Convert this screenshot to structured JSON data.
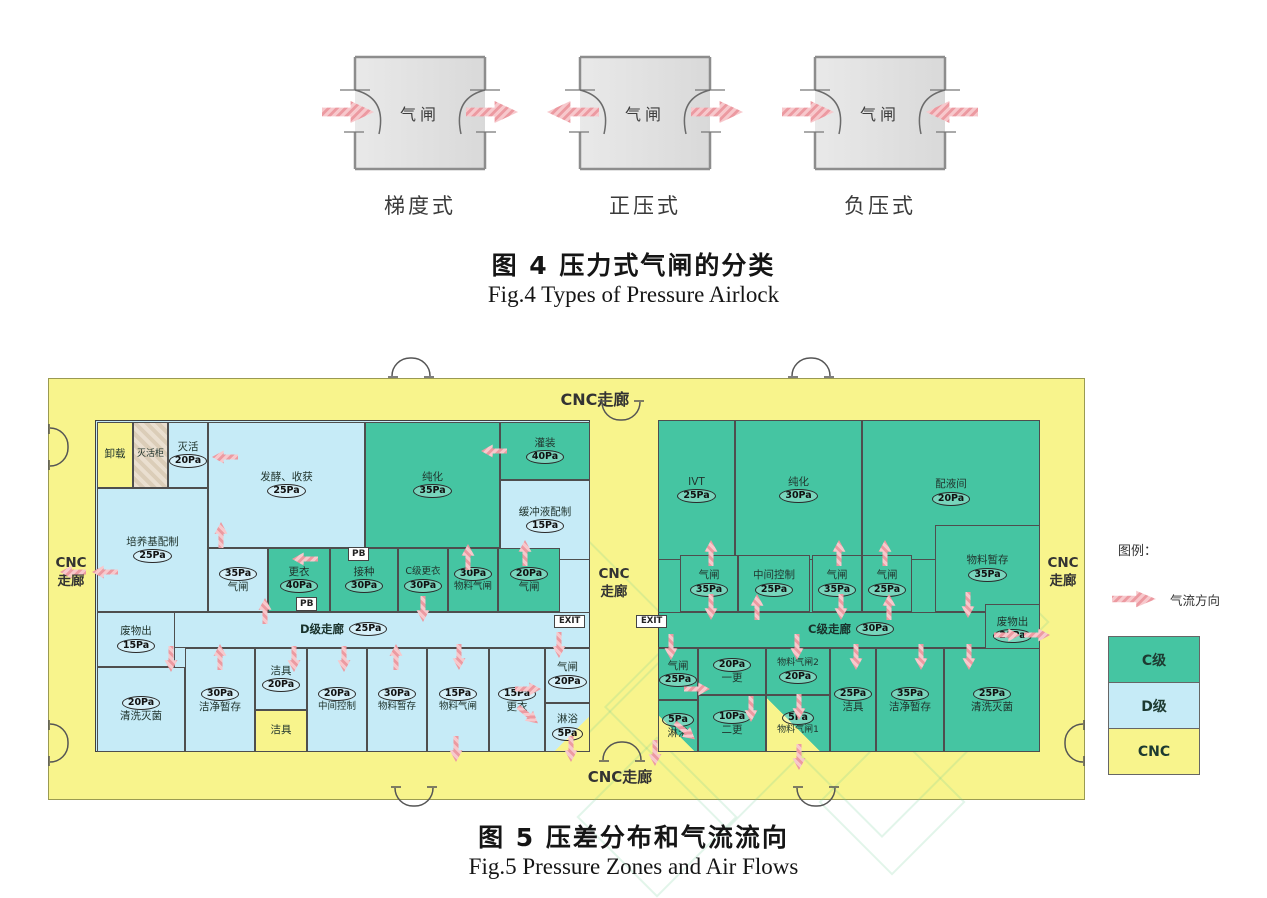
{
  "figure4": {
    "caption_cn": "图 4  压力式气闸的分类",
    "caption_en": "Fig.4  Types of Pressure Airlock",
    "airlocks": [
      {
        "room_label": "气闸",
        "type_label": "梯度式"
      },
      {
        "room_label": "气闸",
        "type_label": "正压式"
      },
      {
        "room_label": "气闸",
        "type_label": "负压式"
      }
    ]
  },
  "figure5": {
    "caption_cn": "图 5  压差分布和气流流向",
    "caption_en": "Fig.5  Pressure Zones and Air Flows",
    "corridors": {
      "top": "CNC走廊",
      "bottom": "CNC走廊",
      "left_l1": "CNC",
      "left_l2": "走廊",
      "middle_l1": "CNC",
      "middle_l2": "走廊",
      "right_l1": "CNC",
      "right_l2": "走廊",
      "d_corridor": "D级走廊",
      "d_pressure": "25Pa",
      "c_corridor": "C级走廊",
      "c_pressure": "30Pa"
    },
    "exit_label": "EXIT",
    "pb_label": "PB",
    "left_rooms": [
      {
        "label": "卸载",
        "pressure": ""
      },
      {
        "label": "灭活柜",
        "pressure": ""
      },
      {
        "label": "灭活",
        "pressure": "20Pa"
      },
      {
        "label": "培养基配制",
        "pressure": "25Pa"
      },
      {
        "label": "发酵、收获",
        "pressure": "25Pa"
      },
      {
        "label": "纯化",
        "pressure": "35Pa"
      },
      {
        "label": "灌装",
        "pressure": "40Pa"
      },
      {
        "label": "缓冲液配制",
        "pressure": "15Pa"
      },
      {
        "label": "气闸",
        "pressure": "35Pa"
      },
      {
        "label": "更衣",
        "pressure": "40Pa"
      },
      {
        "label": "接种",
        "pressure": "30Pa"
      },
      {
        "label": "C级更衣",
        "pressure": "30Pa"
      },
      {
        "label": "物料气闸",
        "pressure": "30Pa"
      },
      {
        "label": "气闸",
        "pressure": "20Pa"
      },
      {
        "label": "废物出",
        "pressure": "15Pa"
      },
      {
        "label": "清洗灭菌",
        "pressure": "20Pa"
      },
      {
        "label": "洁净暂存",
        "pressure": "30Pa"
      },
      {
        "label": "洁具",
        "pressure": "20Pa"
      },
      {
        "label": "洁具",
        "pressure": ""
      },
      {
        "label": "中间控制",
        "pressure": "20Pa"
      },
      {
        "label": "物料暂存",
        "pressure": "30Pa"
      },
      {
        "label": "物料气闸",
        "pressure": "15Pa"
      },
      {
        "label": "更衣",
        "pressure": "15Pa"
      },
      {
        "label": "气闸",
        "pressure": "20Pa"
      },
      {
        "label": "淋浴",
        "pressure": "5Pa"
      }
    ],
    "right_rooms": [
      {
        "label": "IVT",
        "pressure": "25Pa"
      },
      {
        "label": "纯化",
        "pressure": "30Pa"
      },
      {
        "label": "配液间",
        "pressure": "20Pa"
      },
      {
        "label": "物料暂存",
        "pressure": "35Pa"
      },
      {
        "label": "气闸",
        "pressure": "35Pa"
      },
      {
        "label": "中间控制",
        "pressure": "25Pa"
      },
      {
        "label": "气闸",
        "pressure": "35Pa"
      },
      {
        "label": "气闸",
        "pressure": "25Pa"
      },
      {
        "label": "废物出",
        "pressure": "20Pa"
      },
      {
        "label": "气闸",
        "pressure": "25Pa"
      },
      {
        "label": "淋浴",
        "pressure": "5Pa"
      },
      {
        "label": "一更",
        "pressure": "20Pa"
      },
      {
        "label": "二更",
        "pressure": "10Pa"
      },
      {
        "label": "物料气闸2",
        "pressure": "20Pa"
      },
      {
        "label": "物料气闸1",
        "pressure": "5Pa"
      },
      {
        "label": "洁具",
        "pressure": "25Pa"
      },
      {
        "label": "洁净暂存",
        "pressure": "35Pa"
      },
      {
        "label": "清洗灭菌",
        "pressure": "25Pa"
      }
    ],
    "legend": {
      "title": "图例：",
      "flow_label": "气流方向",
      "zones": [
        {
          "label": "C级",
          "color": "#45c5a2"
        },
        {
          "label": "D级",
          "color": "#c6ebf7"
        },
        {
          "label": "CNC",
          "color": "#f8f48c"
        }
      ]
    }
  },
  "colors": {
    "c_grade": "#45c5a2",
    "d_grade": "#c6ebf7",
    "cnc": "#f8f48c",
    "arrow": "#eda3a8"
  }
}
